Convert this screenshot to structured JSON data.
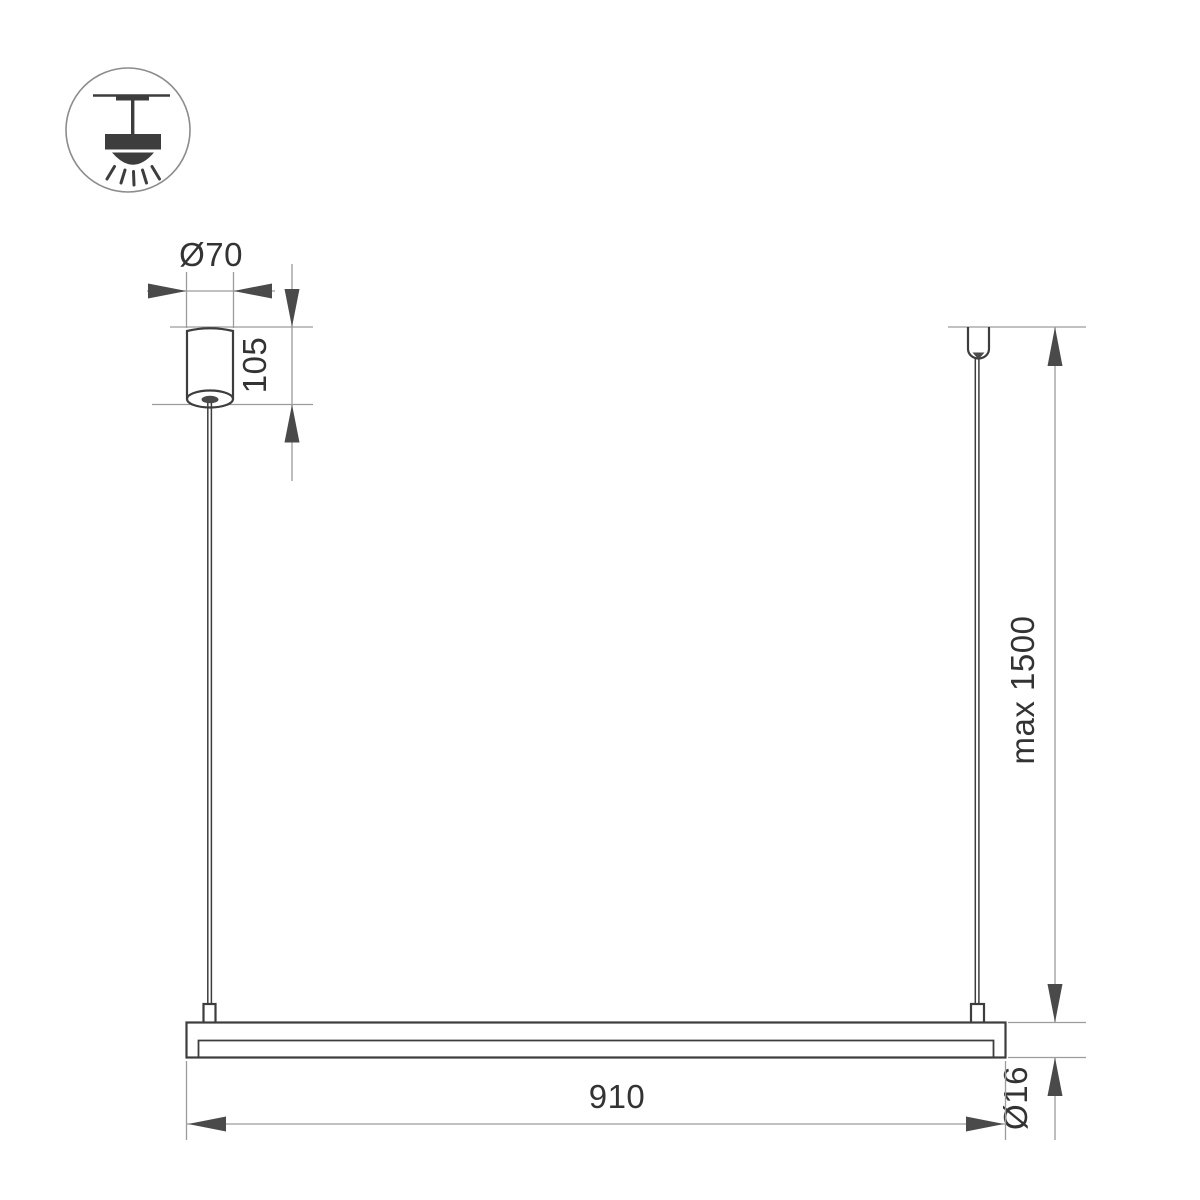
{
  "drawing": {
    "type": "technical-dimension-drawing",
    "subject": "linear-pendant-lamp",
    "labels": {
      "canopy_diameter": "Ø70",
      "canopy_height": "105",
      "suspension_max_length": "max 1500",
      "fixture_length": "910",
      "tube_diameter": "Ø16"
    },
    "legend_icon": "ceiling-pendant-light-icon"
  },
  "colors": {
    "object_line": "#3d3d3d",
    "dimension_line": "#9c9c9c",
    "arrow_fill": "#4a4a4a",
    "text_color": "#333333",
    "icon_stroke": "#8c8c8c",
    "page_bg": "#ffffff"
  }
}
